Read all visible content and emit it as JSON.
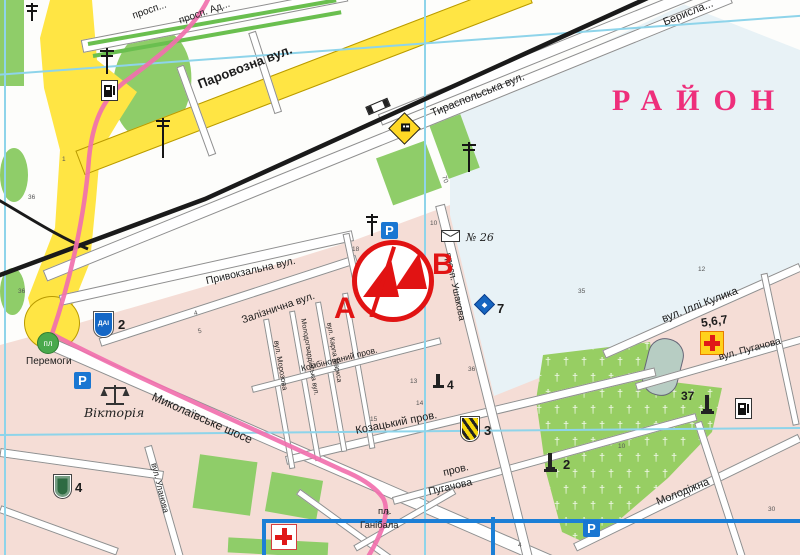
{
  "region_label": "РАЙОН",
  "marker": {
    "a_label": "A",
    "b_label": "B"
  },
  "streets": {
    "parovozna": "Паровозна вул.",
    "tyraspolska": "Тираспольська вул.",
    "beryslavske": "Берисла...",
    "prospekt_a": "просп...",
    "prospekt_b": "просп. Ад...",
    "pryvokzalna": "Привокзальна вул.",
    "zaliznychna": "Залізнична вул.",
    "mykolaivske": "Миколаївське шосе",
    "kozatskyi": "Козацький пров.",
    "prov_puhachova_1": "пров.",
    "prov_puhachova_2": "Пугачова",
    "vul_puhachova": "вул. Пугачова",
    "illi_kulyka": "вул. Іллі Кулика",
    "molodizhna": "Молодіжна",
    "ulanova": "вул. Уланова",
    "ushakova": "просп. Ушакова",
    "morozova": "вул. Морозова",
    "molodohvardiiska": "Молодогвардійська вул.",
    "karla_marksa": "вул. Карла Маркса",
    "kombinovanyi": "Комбінований пров."
  },
  "places": {
    "peremohy_abbr": "пл",
    "peremohy": "Перемоги",
    "viktoria": "Вікторія",
    "hanibala_abbr": "пл.",
    "hanibala": "Ганібала",
    "post_office": "№ 26"
  },
  "poi": {
    "dai": "ДАІ",
    "dai_num": "2",
    "hotel_num": "7",
    "green_shield_num": "4",
    "striped_shield_num": "3",
    "monument_num": "2",
    "monument37_num": "37",
    "hospital_nums": "5,6,7",
    "well_num": "4"
  },
  "block_numbers": [
    {
      "t": "1",
      "x": 62,
      "y": 156,
      "r": 0
    },
    {
      "t": "36",
      "x": 28,
      "y": 194,
      "r": 0
    },
    {
      "t": "36",
      "x": 18,
      "y": 288,
      "r": 0
    },
    {
      "t": "4",
      "x": 194,
      "y": 310,
      "r": -15
    },
    {
      "t": "5",
      "x": 198,
      "y": 328,
      "r": -15
    },
    {
      "t": "70",
      "x": 441,
      "y": 176,
      "r": 70
    },
    {
      "t": "10",
      "x": 430,
      "y": 220,
      "r": 0
    },
    {
      "t": "18",
      "x": 352,
      "y": 246,
      "r": 0
    },
    {
      "t": "36",
      "x": 468,
      "y": 366,
      "r": 0
    },
    {
      "t": "13",
      "x": 410,
      "y": 378,
      "r": 0
    },
    {
      "t": "14",
      "x": 416,
      "y": 400,
      "r": 0
    },
    {
      "t": "3",
      "x": 420,
      "y": 288,
      "r": 0
    },
    {
      "t": "35",
      "x": 578,
      "y": 288,
      "r": 0
    },
    {
      "t": "12",
      "x": 698,
      "y": 266,
      "r": 0
    },
    {
      "t": "15",
      "x": 370,
      "y": 416,
      "r": 0
    },
    {
      "t": "8",
      "x": 386,
      "y": 510,
      "r": 0
    },
    {
      "t": "10",
      "x": 618,
      "y": 443,
      "r": 0
    },
    {
      "t": "30",
      "x": 768,
      "y": 506,
      "r": 0
    },
    {
      "t": "4",
      "x": 518,
      "y": 542,
      "r": 0
    }
  ],
  "colors": {
    "route_pink": "#f170ae",
    "marker_red": "#e11313",
    "district_pink": "#ee2f7b",
    "grid_cyan": "#8ed4ea",
    "inset_blue": "#1c7fd6",
    "block_pink": "#f5ddd6",
    "zone_blue": "#e8f2f6",
    "road_yellow": "#ffe544",
    "park_green": "#8fcd69"
  }
}
